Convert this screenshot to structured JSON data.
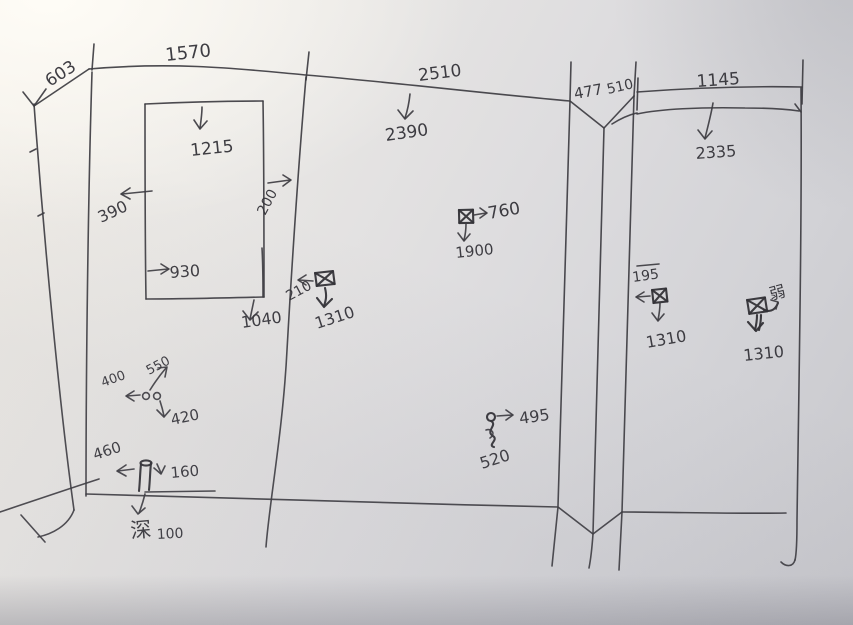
{
  "description": "Hand-drawn wall elevation measurement sketch on paper (photo), with dimension arrows, window opening and electrical/plumbing symbols",
  "ink_color": "#3d3c41",
  "symbols": {
    "socket": "crossed-box-socket-icon",
    "faucet": "circle-squiggle-water-icon",
    "pipe": "floor-pipe-icon",
    "double_circle": "twin-outlet-circles-icon"
  },
  "dims": {
    "top_603": "603",
    "top_1570": "1570",
    "top_2510": "2510",
    "height_2390": "2390",
    "top_477": "477",
    "top_510": "510",
    "top_1145": "1145",
    "height_2335": "2335",
    "win_1215": "1215",
    "win_390": "390",
    "win_200": "200",
    "win_930": "930",
    "win_1040": "1040",
    "sockA_210": "210",
    "sockA_1310": "1310",
    "sockB_760": "760",
    "sockB_1900": "1900",
    "faucet_495": "495",
    "faucet_520": "520",
    "cluster_400": "400",
    "cluster_550": "550",
    "cluster_420": "420",
    "pipe_460": "460",
    "pipe_160": "160",
    "depth_char": "深",
    "depth_100": "100",
    "sockC_195": "195",
    "sockC_1310": "1310",
    "sockD_label": "弱",
    "sockD_1310": "1310"
  }
}
